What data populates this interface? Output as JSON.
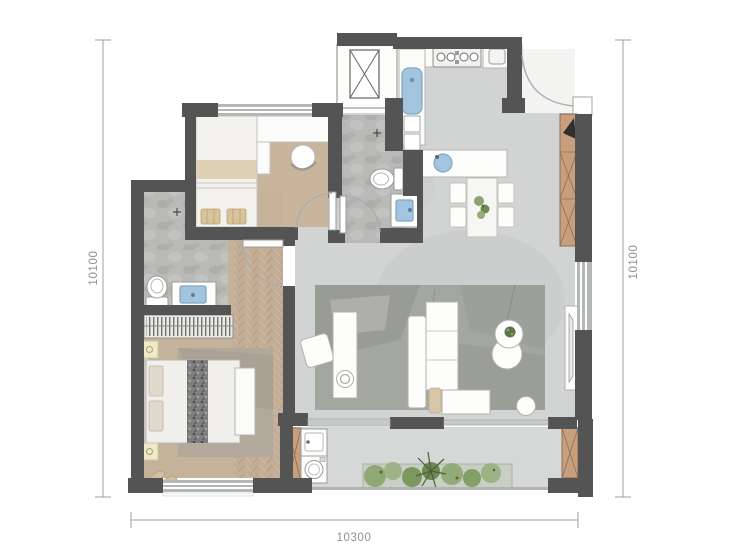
{
  "floorplan": {
    "dimensions": {
      "left": "10100",
      "right": "10100",
      "bottom": "10300"
    },
    "colors": {
      "wall": "#545454",
      "window_band": "#b3b7b6",
      "floor_concrete": "#d2d4d3",
      "floor_wood": "#c9b59e",
      "floor_herringbone": "#c3ad96",
      "floor_stone": "#b9b9b7",
      "balcony_floor": "#d6d8d7",
      "cabinet_wood": "#c79f7c",
      "fixture_blue": "#a3c4de",
      "rug_living": "#a4a7a0",
      "rug_bedroom": "#b3a89c",
      "plant_green": "#7fa05e",
      "dimension_line": "#9aa0a2",
      "background": "#ffffff"
    }
  }
}
